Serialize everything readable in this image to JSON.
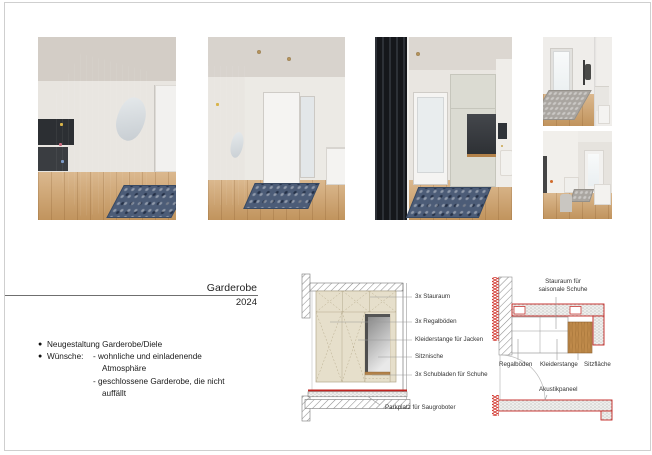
{
  "page": {
    "title": "Garderobe",
    "year": "2024"
  },
  "notes": {
    "bullet": "●",
    "item1": "Neugestaltung Garderobe/Diele",
    "item2": "Wünsche:",
    "wish1a": "- wohnliche und einladenende",
    "wish1b": "Atmosphäre",
    "wish2a": "- geschlossene Garderobe, die nicht",
    "wish2b": "auffällt"
  },
  "elevation": {
    "labels": [
      "3x Stauraum",
      "3x Regalböden",
      "Kleiderstange für Jacken",
      "Sitznische",
      "3x Schubladen für Schuhe"
    ],
    "floor_label": "Parkplatz für Saugroboter"
  },
  "plan": {
    "top_label_line1": "Stauraum für",
    "top_label_line2": "saisonale Schuhe",
    "labels": [
      "Regalböden",
      "Kleiderstange",
      "Sitzfläche"
    ],
    "panel_label": "Akustikpaneel"
  },
  "colors": {
    "accent_red": "#c2231f",
    "cabinet_beige": "#e6dfcb",
    "seat_wood": "#bf8a4a"
  }
}
